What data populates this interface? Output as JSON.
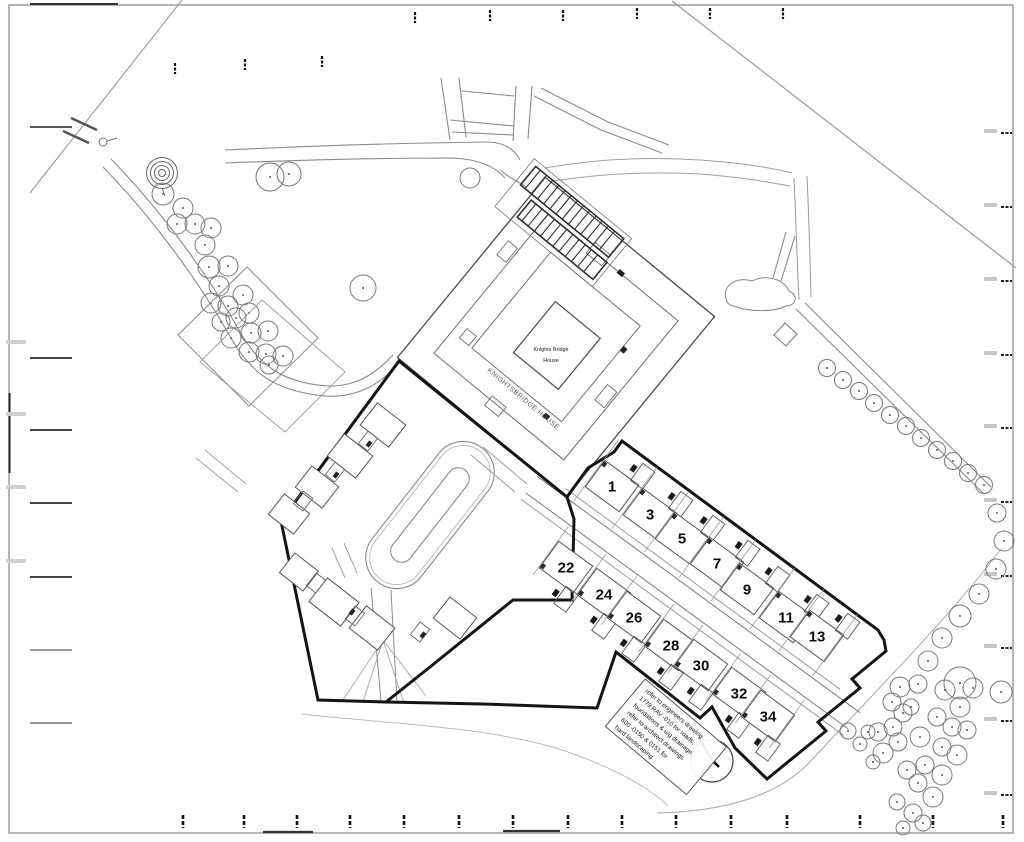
{
  "drawing": {
    "knightsbridge_house_boundary_label": "KNIGHTSBRIDGE HOUSE",
    "knightsbridge_house_label_line1": "Knights Bridge",
    "knightsbridge_house_label_line2": "House"
  },
  "plots": {
    "row_north": [
      "1",
      "3",
      "5",
      "7",
      "9",
      "11",
      "13"
    ],
    "row_south": [
      "22",
      "24",
      "26",
      "28",
      "30",
      "32",
      "34"
    ]
  },
  "annotations": {
    "note_lines": [
      "refer to engineers drawing",
      "1779 RAV -010 for roads,",
      "foundations & u/g drainage.",
      "refer to architect drawings",
      "600 -0150 & 0151 for",
      "hard landscaping"
    ]
  },
  "colors": {
    "background": "#ffffff",
    "line": "#6f6f6f",
    "light_line": "#9a9a9a",
    "boundary": "#141414",
    "text": "#1a1a1a"
  }
}
